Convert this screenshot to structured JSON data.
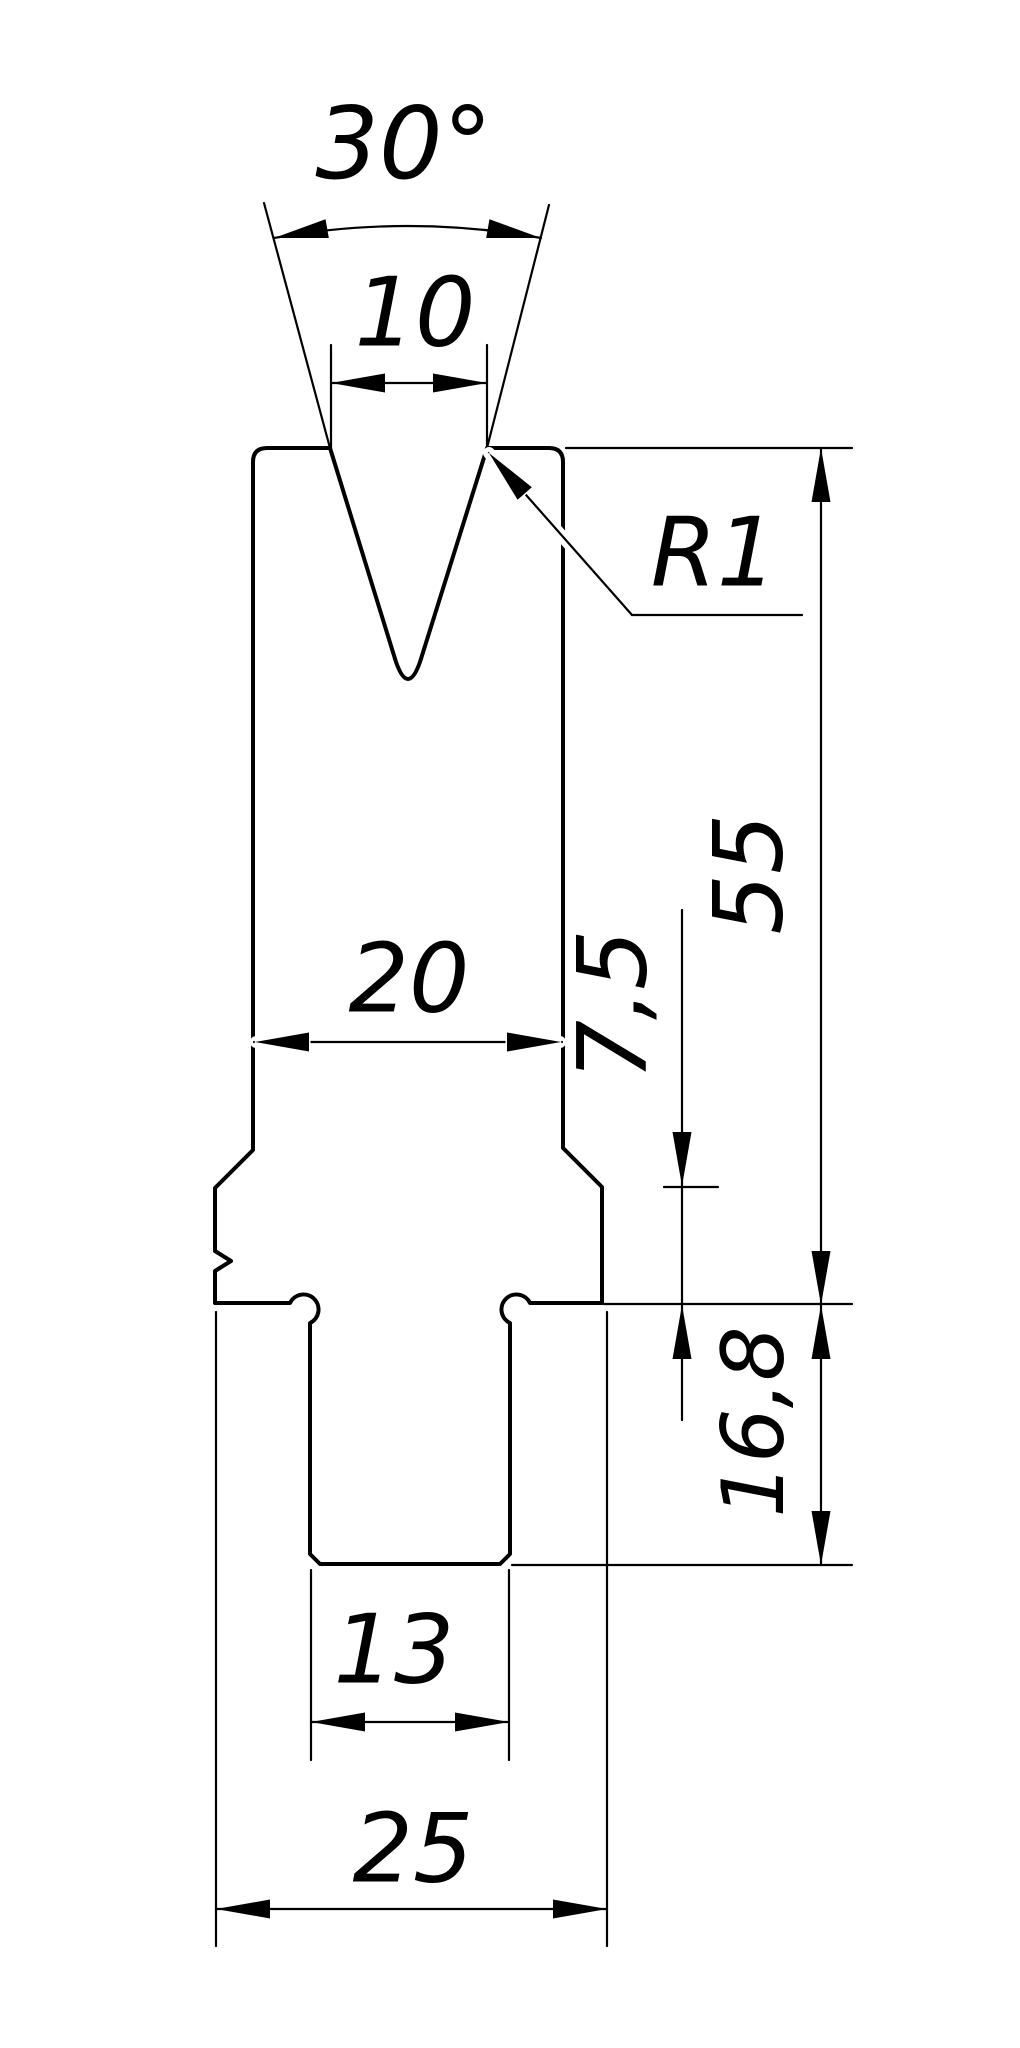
{
  "drawing": {
    "labels": {
      "groove_angle": "30°",
      "groove_opening": "10",
      "corner_radius": "R1",
      "body_width": "20",
      "shoulder_height": "7,5",
      "working_height": "55",
      "base_height": "16,8",
      "tang_width": "13",
      "base_width": "25"
    },
    "colors": {
      "background": "#ffffff",
      "body_fill": "#d8d8d8",
      "line": "#000000"
    }
  }
}
